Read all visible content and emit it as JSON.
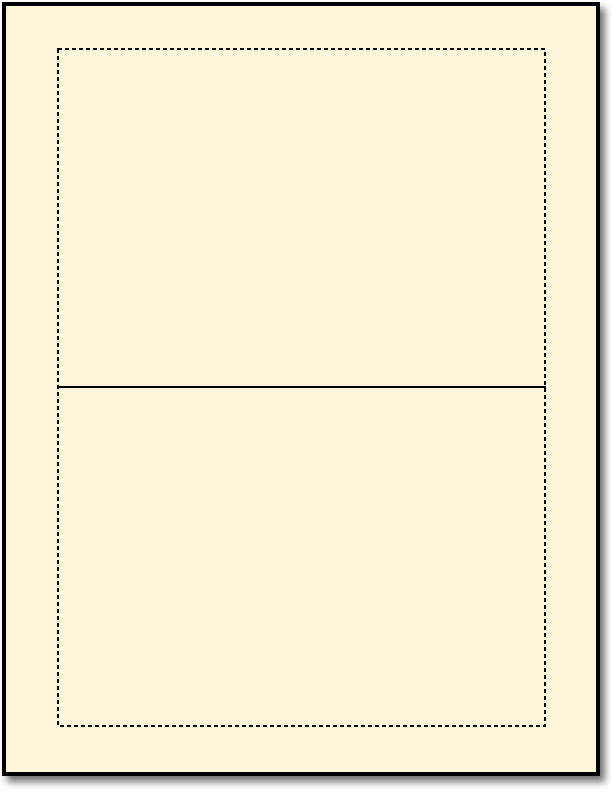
{
  "background": "#ffffff",
  "shadow": "rgba(0,0,0,0.55)",
  "sheet": {
    "fill": "#fcf5dc",
    "border_color": "#000000"
  },
  "guides": {
    "cut_line": {
      "style": "dashed",
      "color": "#000000"
    },
    "fold_line": {
      "style": "solid",
      "color": "#000000"
    }
  }
}
